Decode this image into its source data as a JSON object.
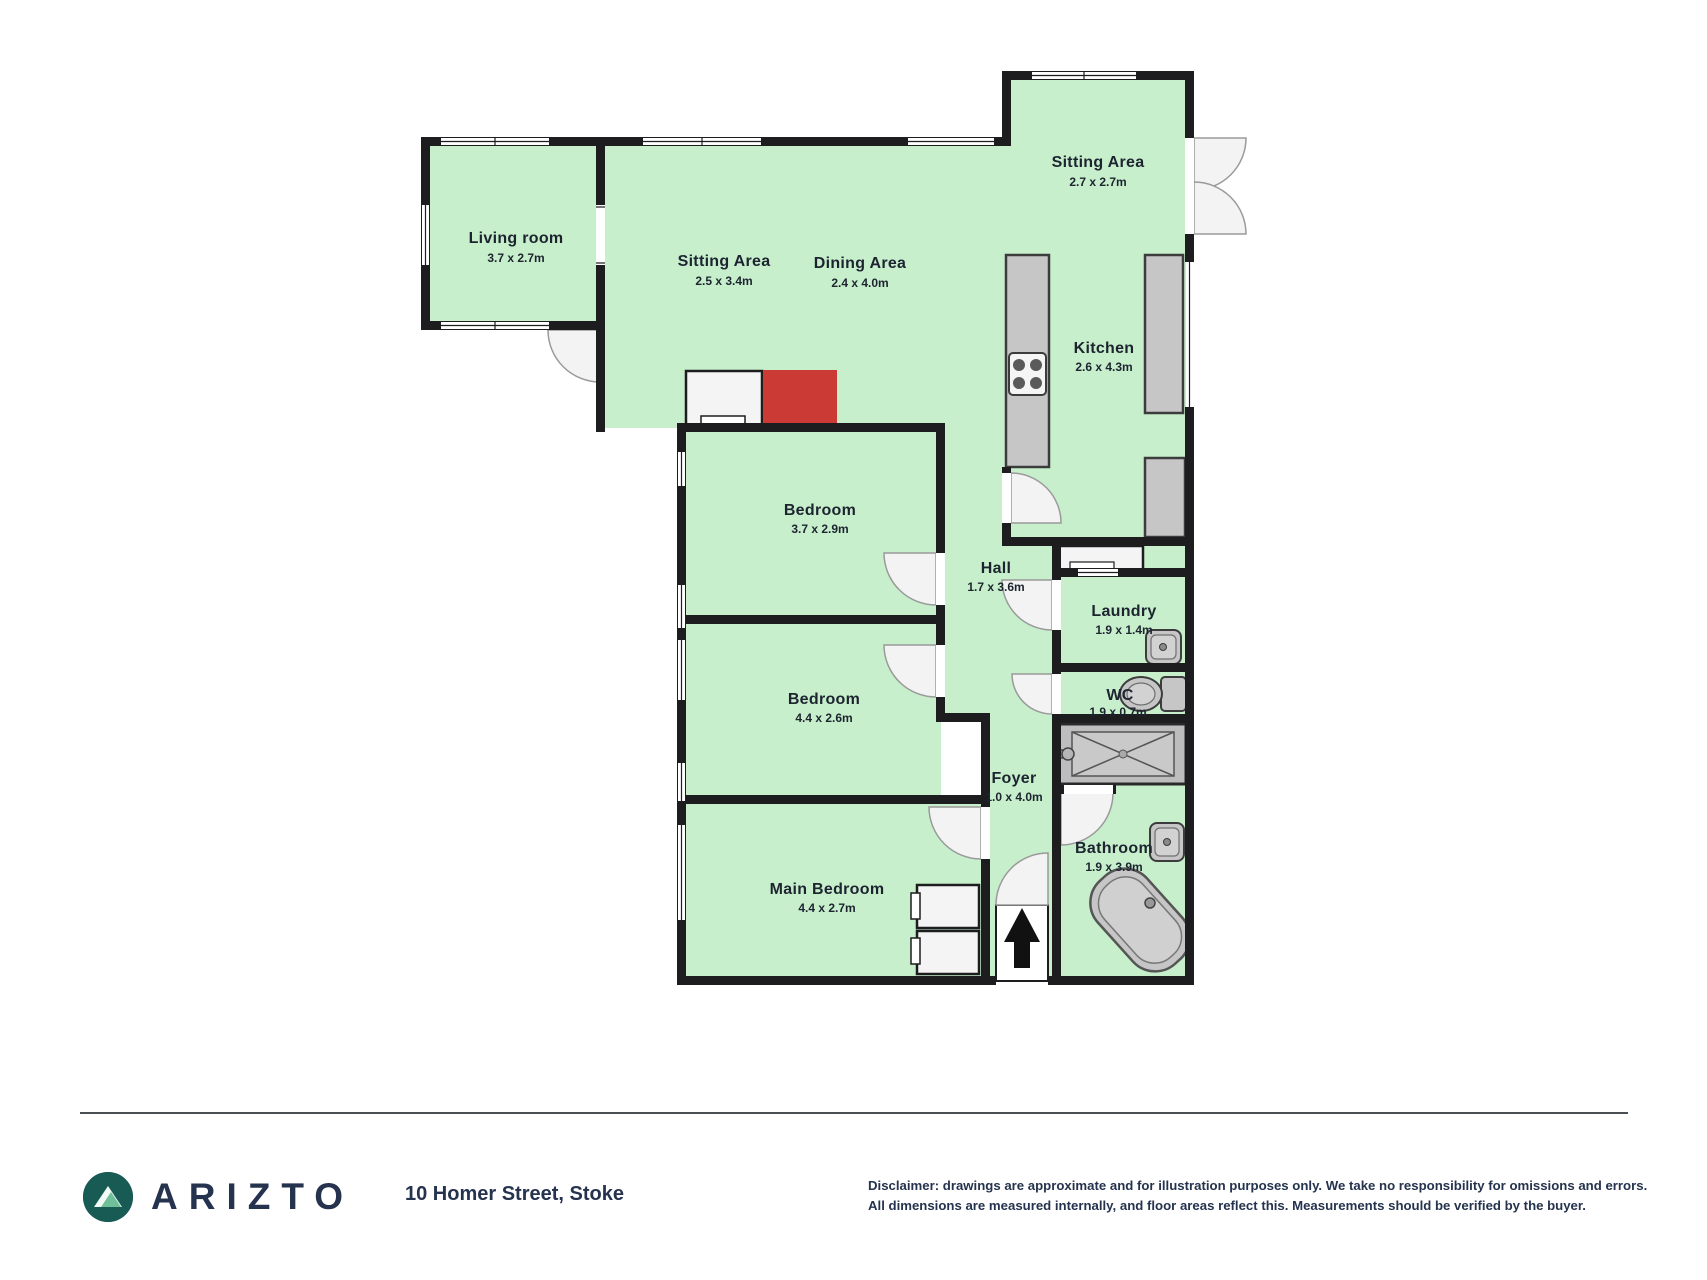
{
  "floorplan": {
    "rooms": [
      {
        "id": "living-room",
        "name": "Living room",
        "dims": "3.7 x 2.7m"
      },
      {
        "id": "sitting-area-1",
        "name": "Sitting Area",
        "dims": "2.5 x 3.4m"
      },
      {
        "id": "dining-area",
        "name": "Dining Area",
        "dims": "2.4 x 4.0m"
      },
      {
        "id": "sitting-area-2",
        "name": "Sitting Area",
        "dims": "2.7 x 2.7m"
      },
      {
        "id": "kitchen",
        "name": "Kitchen",
        "dims": "2.6 x 4.3m"
      },
      {
        "id": "bedroom-1",
        "name": "Bedroom",
        "dims": "3.7 x 2.9m"
      },
      {
        "id": "hall",
        "name": "Hall",
        "dims": "1.7 x 3.6m"
      },
      {
        "id": "laundry",
        "name": "Laundry",
        "dims": "1.9 x 1.4m"
      },
      {
        "id": "bedroom-2",
        "name": "Bedroom",
        "dims": "4.4 x 2.6m"
      },
      {
        "id": "wc",
        "name": "WC",
        "dims": "1.9 x 0.7m"
      },
      {
        "id": "foyer",
        "name": "Foyer",
        "dims": "1.0 x 4.0m"
      },
      {
        "id": "bathroom",
        "name": "Bathroom",
        "dims": "1.9 x 3.9m"
      },
      {
        "id": "main-bedroom",
        "name": "Main Bedroom",
        "dims": "4.4 x 2.7m"
      }
    ],
    "colors": {
      "floor": "#c7efcc",
      "wall": "#1d1d1f",
      "fireplace": "#cb3a34",
      "fixture_gray": "#c6c6c6",
      "brand_teal": "#185a54",
      "brand_navy": "#25334e"
    }
  },
  "footer": {
    "brand": "ARIZTO",
    "logo": "mountain-in-circle",
    "address": "10 Homer Street, Stoke",
    "disclaimer_line1": "Disclaimer: drawings are approximate and for illustration purposes only. We take no responsibility for omissions and errors.",
    "disclaimer_line2": "All dimensions are measured internally, and floor areas reflect this. Measurements should be verified by the buyer."
  }
}
